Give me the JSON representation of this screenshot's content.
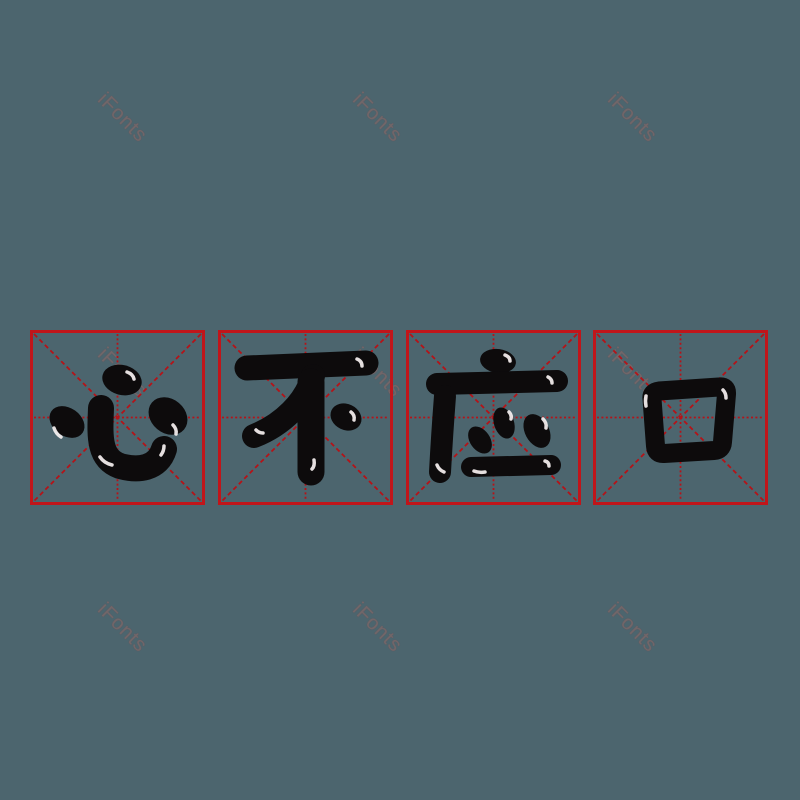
{
  "artboard": {
    "width": 800,
    "height": 800,
    "background": "#4c656e"
  },
  "watermark": {
    "text": "iFonts",
    "color": "#756769",
    "opacity": 0.92,
    "rotation_deg": 45,
    "font_size_px": 20,
    "positions": [
      {
        "x": 122,
        "y": 118
      },
      {
        "x": 377,
        "y": 118
      },
      {
        "x": 632,
        "y": 118
      },
      {
        "x": 122,
        "y": 373
      },
      {
        "x": 377,
        "y": 373
      },
      {
        "x": 632,
        "y": 373
      },
      {
        "x": 122,
        "y": 628
      },
      {
        "x": 377,
        "y": 628
      },
      {
        "x": 632,
        "y": 628
      }
    ]
  },
  "phrase": {
    "text": "心不应口",
    "reading_order": "left-to-right",
    "characters": [
      {
        "index": 1,
        "char": "心"
      },
      {
        "index": 2,
        "char": "不"
      },
      {
        "index": 3,
        "char": "应"
      },
      {
        "index": 4,
        "char": "口"
      }
    ]
  },
  "practice_grid": {
    "style": "mi-zi-ge",
    "square_size_px": 175,
    "top_px": 330,
    "lefts_px": [
      30,
      218,
      406,
      593
    ],
    "border_color": "#c1151a",
    "line_color": "#b51318",
    "ink_color": "#0d0b0c",
    "highlight_color": "#f7f2f2"
  }
}
